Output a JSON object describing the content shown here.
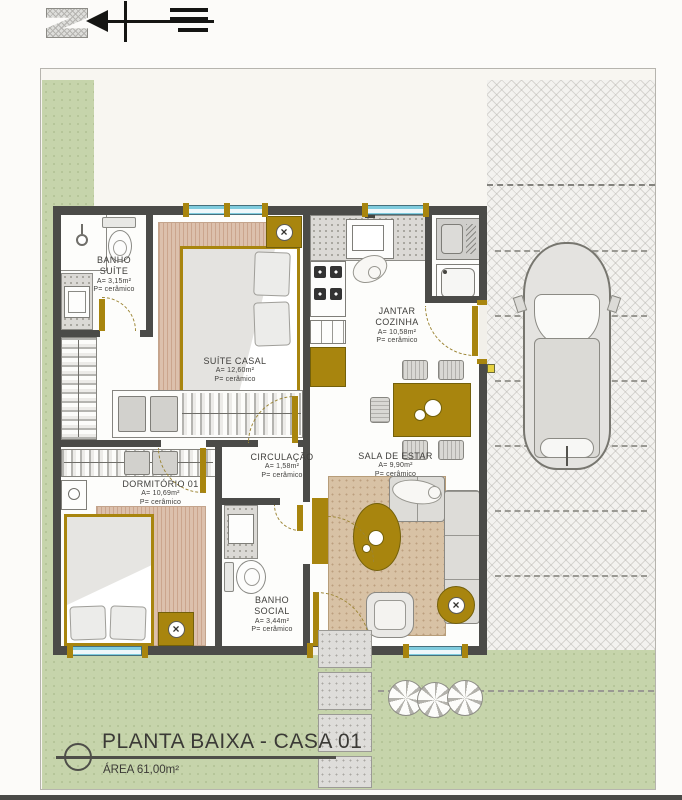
{
  "colors": {
    "wall": "#4b4b48",
    "wood_gold": "#a8850e",
    "grass": "#c6d4ab",
    "window_glass": "#7fcbdd",
    "rug_bedroom": "#dcc0ac",
    "rug_living": "#d8c2a5",
    "sheet_bg": "#f8f6f1"
  },
  "title_block": {
    "title": "PLANTA BAIXA - CASA 01",
    "area": "ÁREA 61,00m²"
  },
  "rooms": [
    {
      "name": "BANHO SUÍTE",
      "area": "A= 3,15m²",
      "floor": "P= cerâmico"
    },
    {
      "name": "SUÍTE CASAL",
      "area": "A= 12,60m²",
      "floor": "P= cerâmico"
    },
    {
      "name": "JANTAR COZINHA",
      "area": "A= 10,58m²",
      "floor": "P= cerâmico"
    },
    {
      "name": "CIRCULAÇÃO",
      "area": "A= 1,58m²",
      "floor": "P= cerâmico"
    },
    {
      "name": "DORMITÓRIO 01",
      "area": "A= 10,69m²",
      "floor": "P= cerâmico"
    },
    {
      "name": "SALA DE ESTAR",
      "area": "A= 9,90m²",
      "floor": "P= cerâmico"
    },
    {
      "name": "BANHO SOCIAL",
      "area": "A= 3,44m²",
      "floor": "P= cerâmico"
    }
  ],
  "icons": {
    "lamp_symbol": "×"
  }
}
